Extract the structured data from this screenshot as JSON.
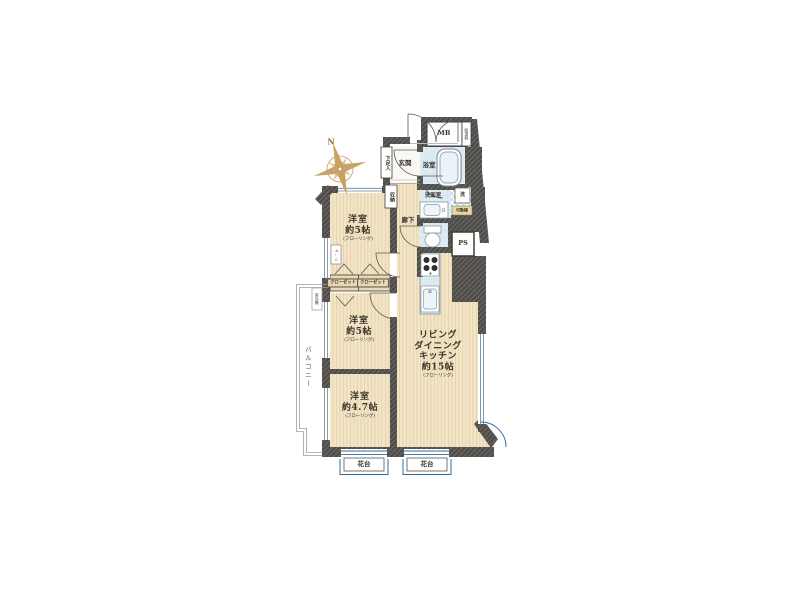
{
  "compass": {
    "north": "N"
  },
  "rooms": {
    "bedroom1": {
      "name": "洋室",
      "size": "約5帖",
      "note": "(フローリング)"
    },
    "bedroom2": {
      "name": "洋室",
      "size": "約5帖",
      "note": "(フローリング)"
    },
    "bedroom3": {
      "name": "洋室",
      "size": "約4.7帖",
      "note": "(フローリング)"
    },
    "ldk": {
      "name1": "リビング",
      "name2": "ダイニング",
      "name3": "キッチン",
      "size": "約15帖",
      "note": "(フローリング)"
    }
  },
  "labels": {
    "entrance": "玄関",
    "bathroom": "浴室",
    "washroom": "洗面室",
    "washer": "洗",
    "movable_shelf": "可動棚",
    "hallway": "廊下",
    "pipe_space": "PS",
    "meter_box": "MB",
    "water_heater": "給湯器",
    "storage": "収納",
    "shoe_cabinet": "下足入",
    "closet_left": "クローゼット",
    "closet_right": "クローゼット",
    "balcony": "バルコニー",
    "outdoor_unit": "室外機",
    "flower_stand_left": "花台",
    "flower_stand_right": "花台",
    "air_conditioner": "A・C"
  },
  "colors": {
    "wall": "#4e4c49",
    "wood_floor": "#f2e4c5",
    "wet_area": "#dcecf5",
    "window_accent": "#2e6da4",
    "compass_gold": "#c8a05e"
  }
}
